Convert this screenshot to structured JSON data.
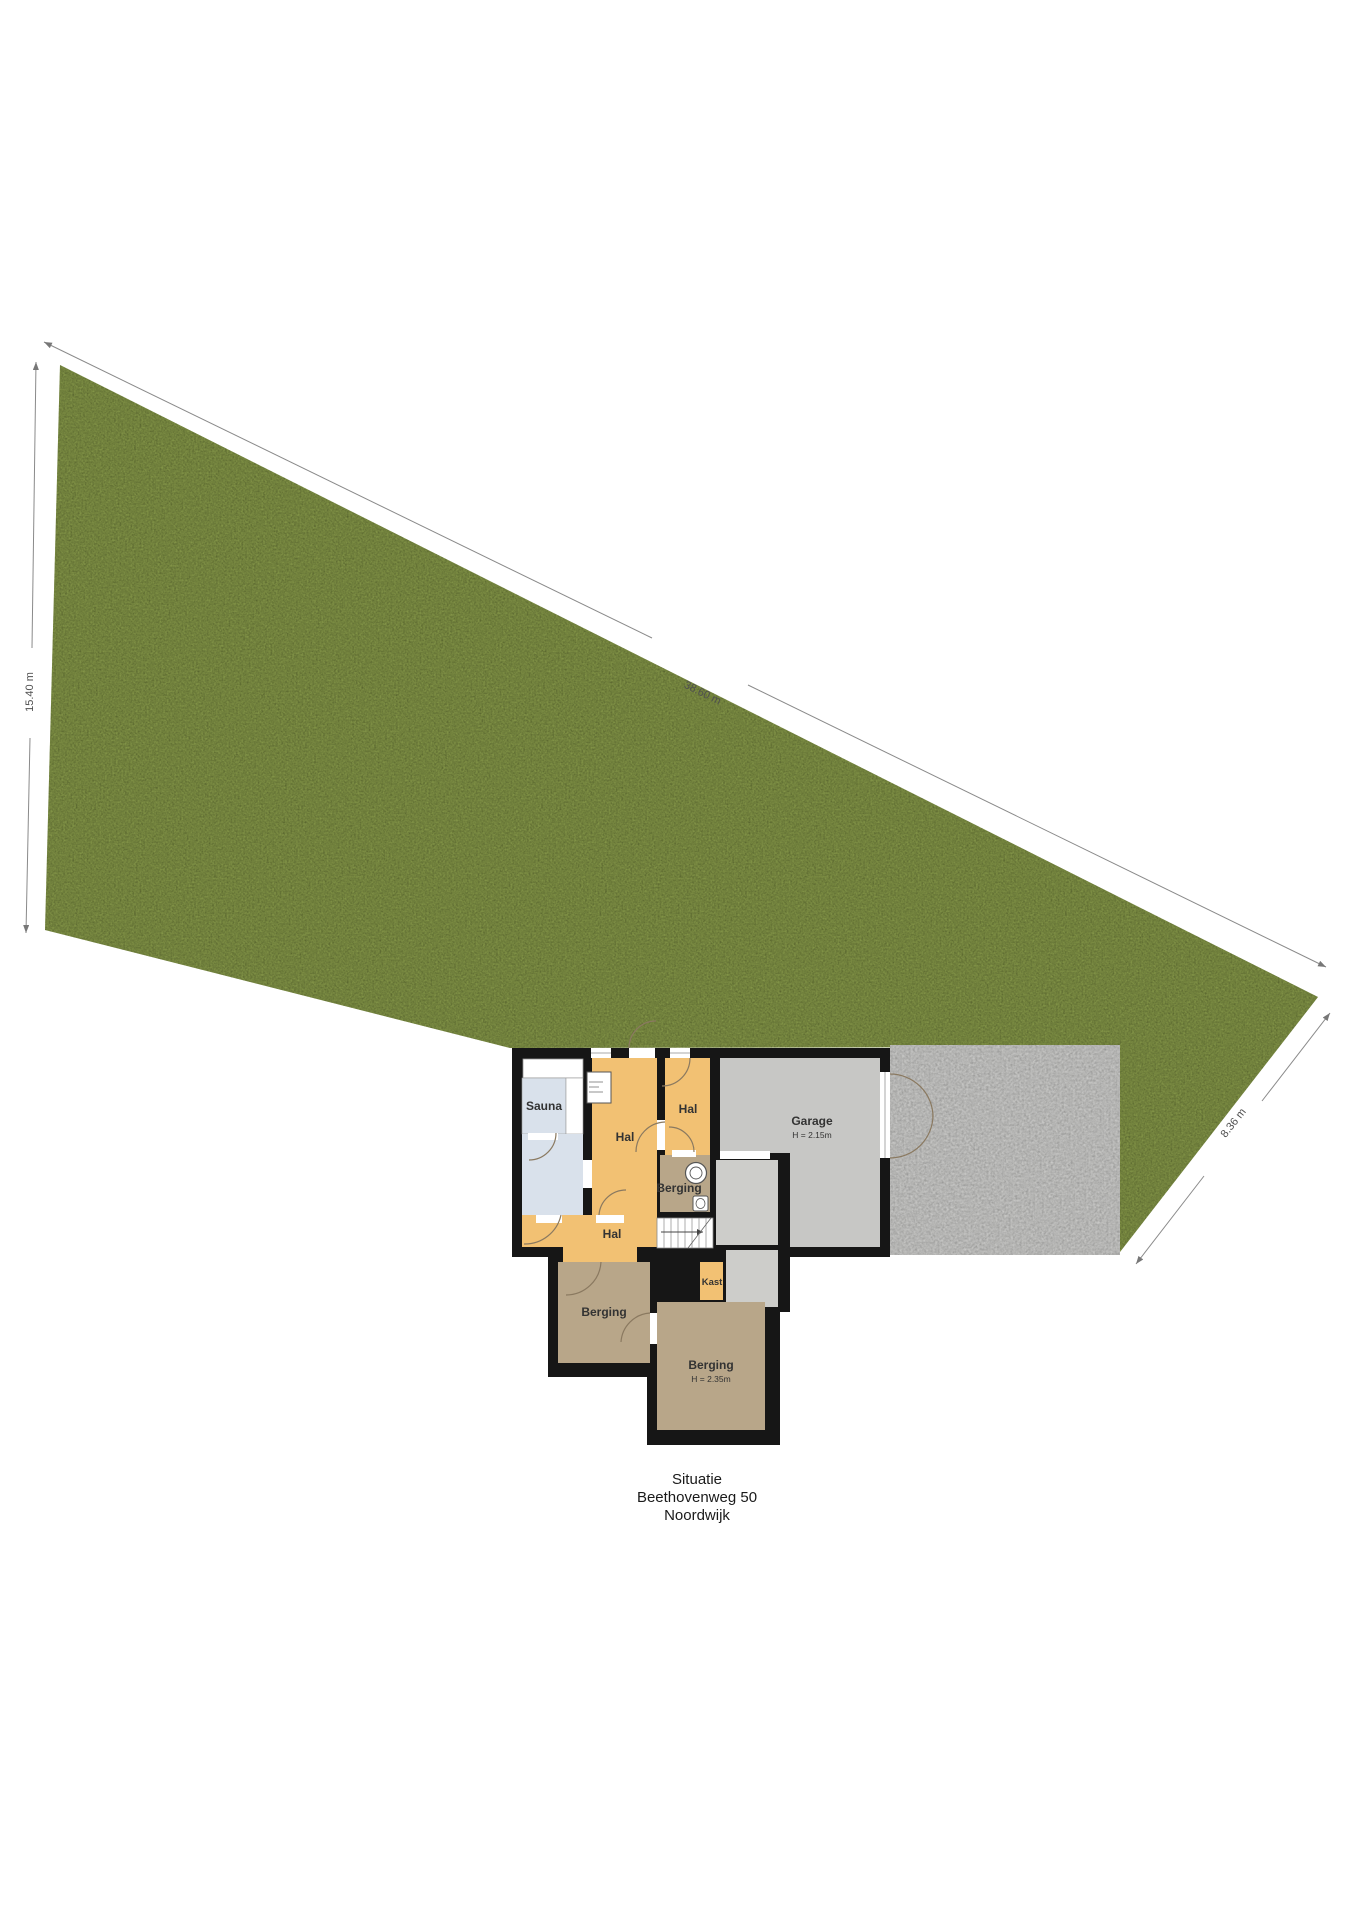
{
  "plan": {
    "title": [
      "Situatie",
      "Beethovenweg 50",
      "Noordwijk"
    ],
    "dimensions": {
      "left": "15.40 m",
      "top": "38.60 m",
      "right": "8.36 m"
    },
    "rooms": {
      "sauna": {
        "label": "Sauna"
      },
      "hal_center": {
        "label": "Hal"
      },
      "hal_upper_right": {
        "label": "Hal"
      },
      "berging_upper": {
        "label": "Berging"
      },
      "garage": {
        "label": "Garage",
        "height": "H = 2.15m"
      },
      "hal_lower": {
        "label": "Hal"
      },
      "kast": {
        "label": "Kast"
      },
      "berging_left": {
        "label": "Berging"
      },
      "berging_bottom": {
        "label": "Berging",
        "height": "H = 2.35m"
      }
    },
    "colors": {
      "grass": "#84964a",
      "concrete": "#cbcbc9",
      "concrete_light": "#cdcdca",
      "wall": "#161616",
      "hal": "#f2c173",
      "berging": "#b8a689",
      "garage": "#c7c7c5",
      "bath": "#d9e1eb",
      "white_room": "#ffffff",
      "dim_line": "#8a8a8a",
      "dim_text": "#4f4f4f",
      "label_text": "#333333",
      "door_arc": "#8a7960"
    }
  }
}
